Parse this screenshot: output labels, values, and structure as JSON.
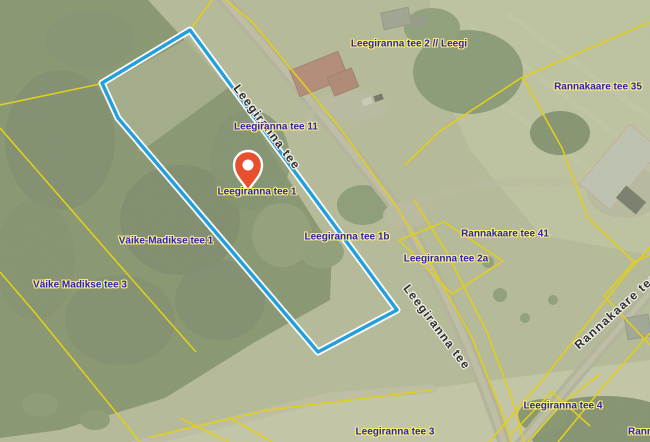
{
  "theme": {
    "boundary_color": "#e0cf1d",
    "highlight_color": "#259fdb",
    "highlight_casing": "#ffffff",
    "address_text_color": "#2424c6",
    "address_halo_color": "#fcec76",
    "road_text_color": "#2e2e2e",
    "road_halo_color": "#f2f0e8",
    "marker_color": "#e8502d"
  },
  "map": {
    "selected_parcel": "Leegiranna tee 1",
    "marker": {
      "icon": "location-pin"
    },
    "address_labels": [
      {
        "text": "Leegiranna tee 2 // Leegi"
      },
      {
        "text": "Leegiranna tee 11"
      },
      {
        "text": "Leegiranna tee 1"
      },
      {
        "text": "Väike-Madikse tee 1"
      },
      {
        "text": "Väike Madikse tee 3"
      },
      {
        "text": "Leegiranna tee 1b"
      },
      {
        "text": "Leegiranna tee 2a"
      },
      {
        "text": "Rannakaare tee 41"
      },
      {
        "text": "Rannakaare tee 35"
      },
      {
        "text": "Leegiranna tee 4"
      },
      {
        "text": "Leegiranna tee 3"
      },
      {
        "text": "Rann"
      }
    ],
    "road_labels": [
      {
        "text": "Leegiranna tee"
      },
      {
        "text": "Leegiranna tee"
      },
      {
        "text": "Rannakaare tee"
      }
    ]
  }
}
